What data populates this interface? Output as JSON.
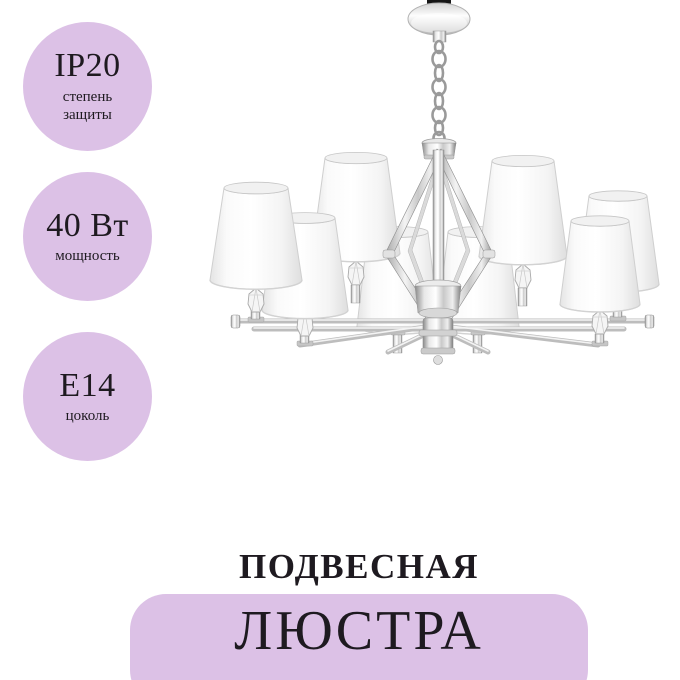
{
  "colors": {
    "accent_lilac": "#dcc1e6",
    "text_dark": "#1e1a20",
    "background": "#ffffff",
    "chrome_gray": "#c9c9c9",
    "shade_white": "#fdfdfd"
  },
  "badges": [
    {
      "value": "IP20",
      "label": "степень защиты"
    },
    {
      "value": "40 Вт",
      "label": "мощность"
    },
    {
      "value": "E14",
      "label": "цоколь"
    }
  ],
  "product": {
    "category_label": "ПОДВЕСНАЯ",
    "name_label": "ЛЮСТРА",
    "image_description": "chrome chandelier, eight white cone shades, crystal candle accents, diamond-shaped frame, chain suspension"
  }
}
